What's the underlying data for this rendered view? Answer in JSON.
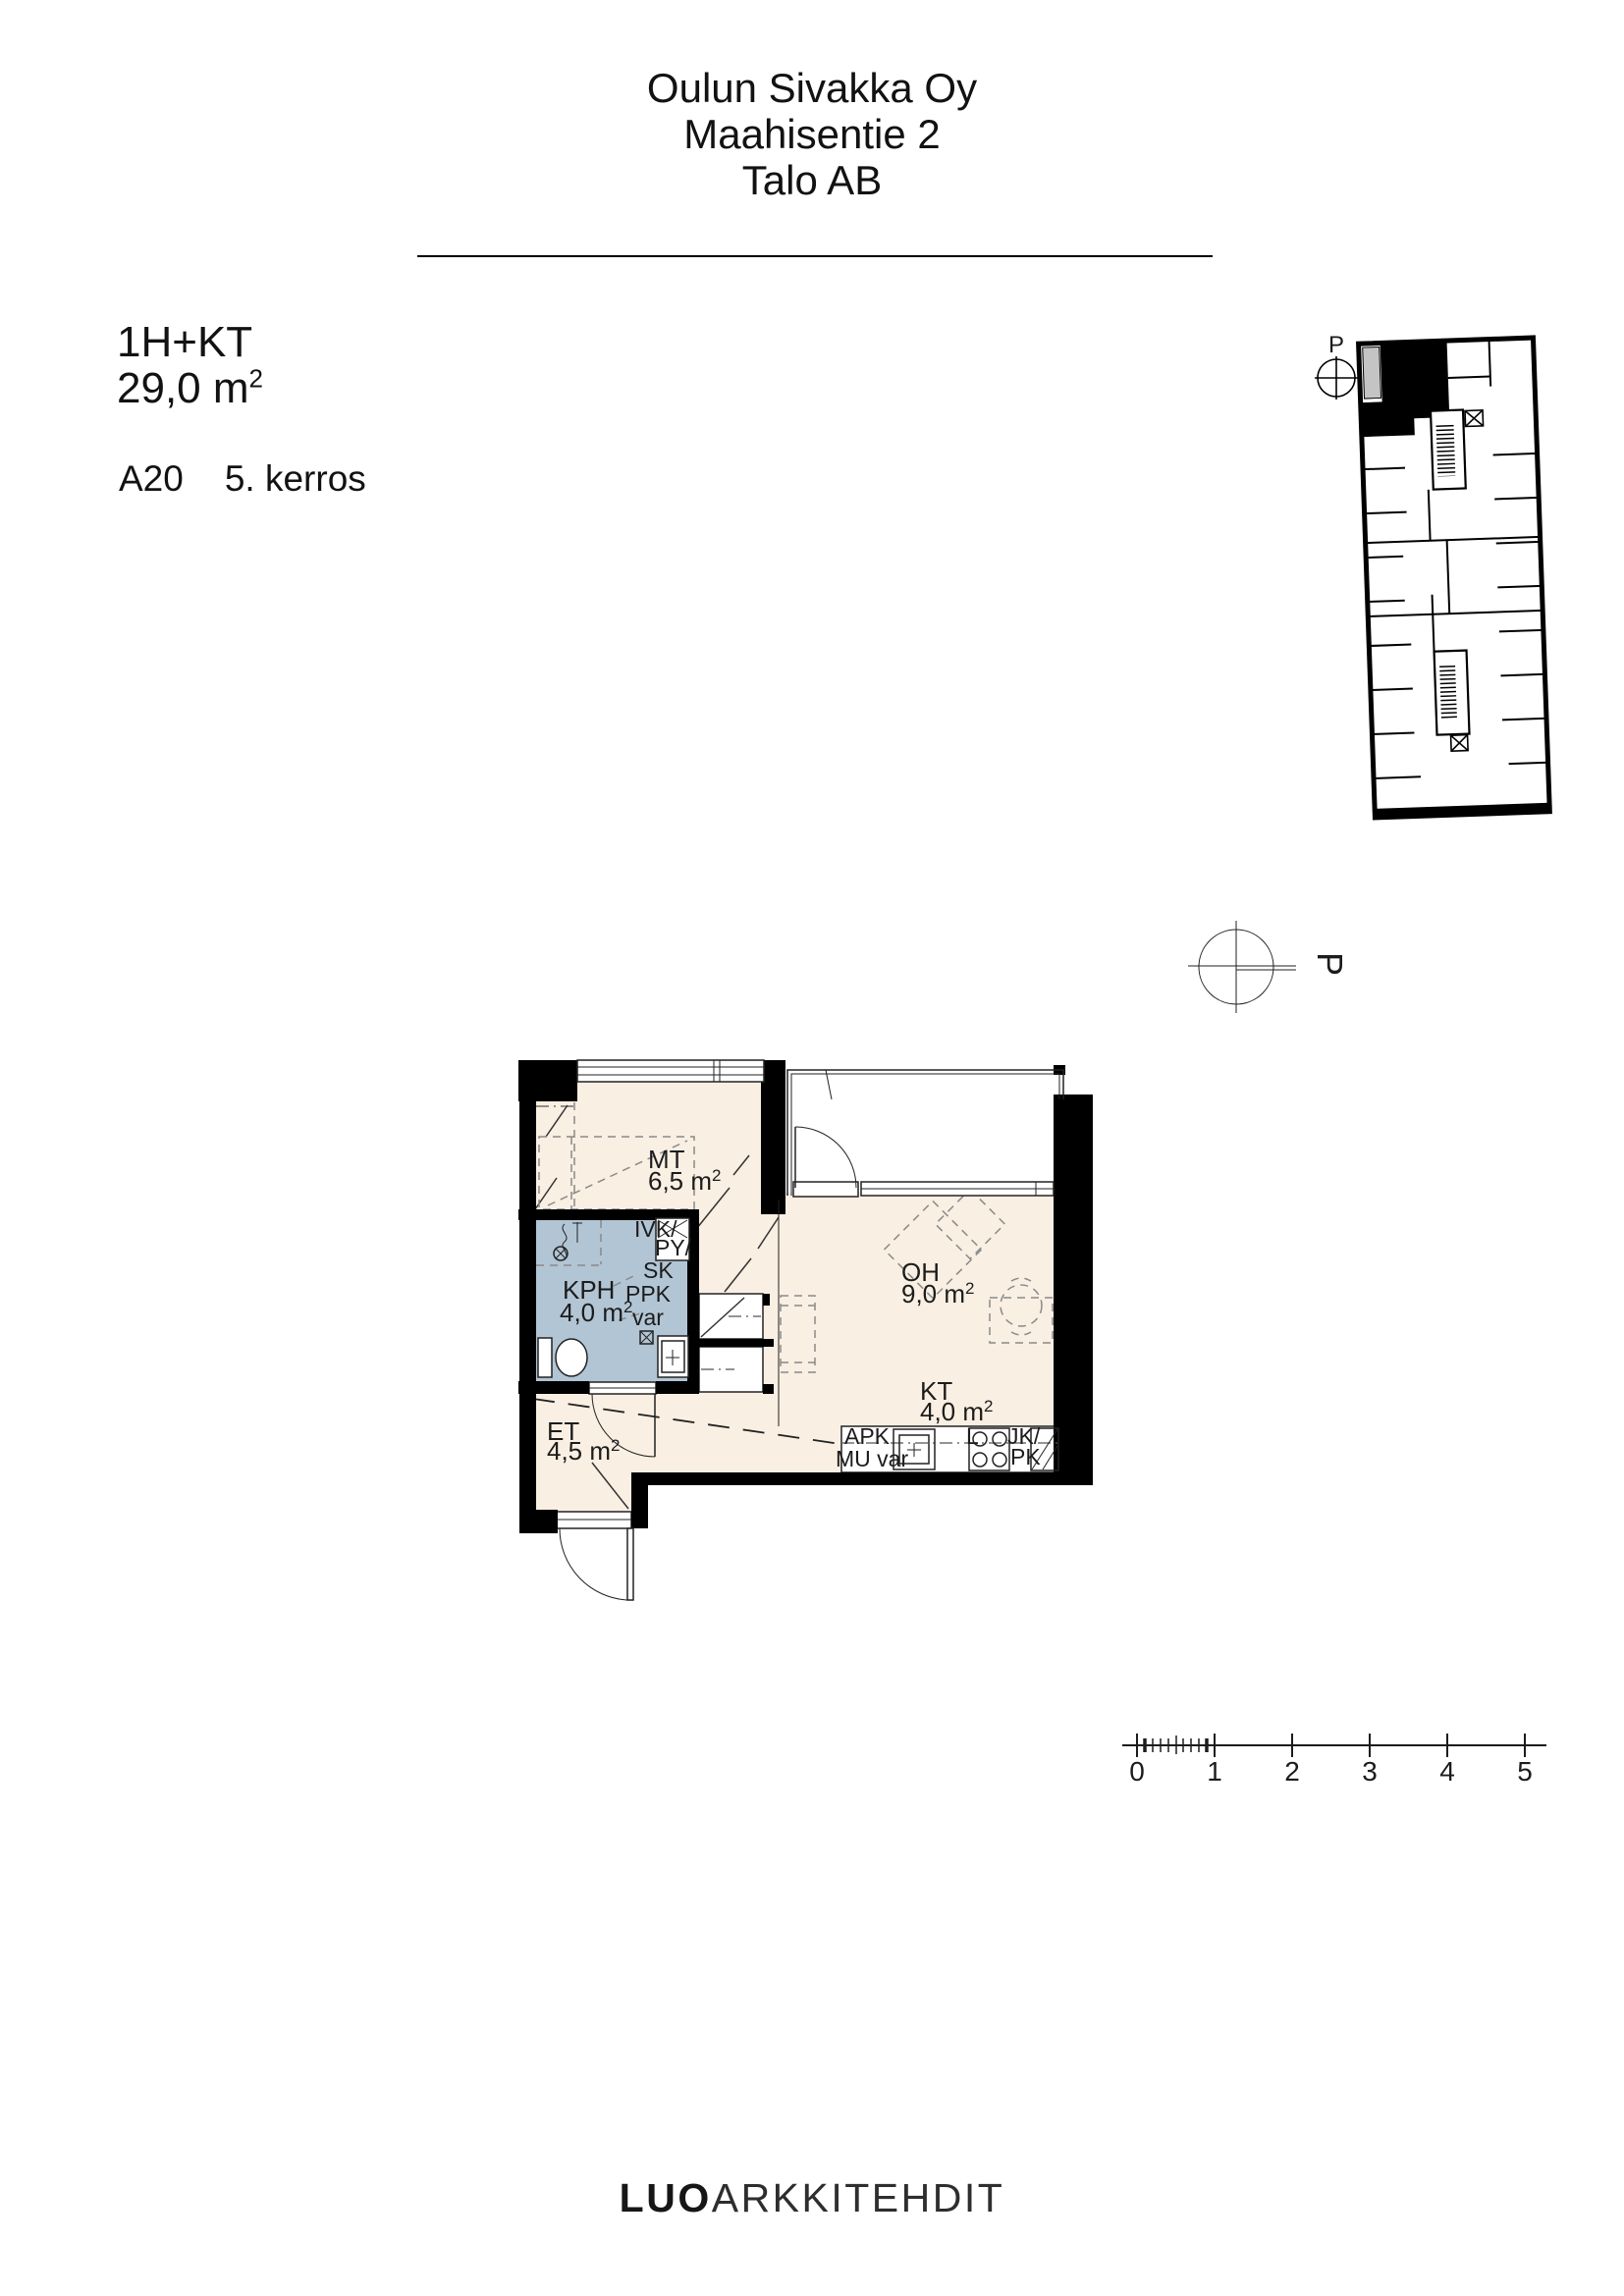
{
  "header": {
    "lines": [
      "Oulun Sivakka Oy",
      "Maahisentie 2",
      "Talo AB"
    ]
  },
  "info": {
    "apartment_type": "1H+KT",
    "area": "29,0 m",
    "area_sup": "2",
    "unit": "A20",
    "floor": "5. kerros"
  },
  "key_plan": {
    "north_label": "P"
  },
  "compass": {
    "north_label": "P"
  },
  "floor_plan": {
    "rooms": {
      "mt": {
        "code": "MT",
        "area": "6,5 m",
        "sup": "2"
      },
      "kph": {
        "code": "KPH",
        "area": "4,0 m",
        "sup": "2"
      },
      "oh": {
        "code": "OH",
        "area": "9,0 m",
        "sup": "2"
      },
      "kt": {
        "code": "KT",
        "area": "4,0 m",
        "sup": "2"
      },
      "et": {
        "code": "ET",
        "area": "4,5 m",
        "sup": "2"
      }
    },
    "fixtures": {
      "ivk": "IVK/",
      "py": "PY/",
      "sk": "SK",
      "ppk": "PPK",
      "var": "var",
      "apk": "APK",
      "mu_var": "MU var",
      "l": "L",
      "jk": "JK/",
      "pk": "PK"
    }
  },
  "scale_bar": {
    "ticks": [
      "0",
      "1",
      "2",
      "3",
      "4",
      "5"
    ]
  },
  "logo": {
    "bold": "LUO",
    "light": "ARKKITEHDIT"
  },
  "colors": {
    "floor_fill": "#f9efe2",
    "wet_room_fill": "#b2c5d5",
    "wall": "#000000",
    "balcony_gray": "#c4c4c4"
  }
}
